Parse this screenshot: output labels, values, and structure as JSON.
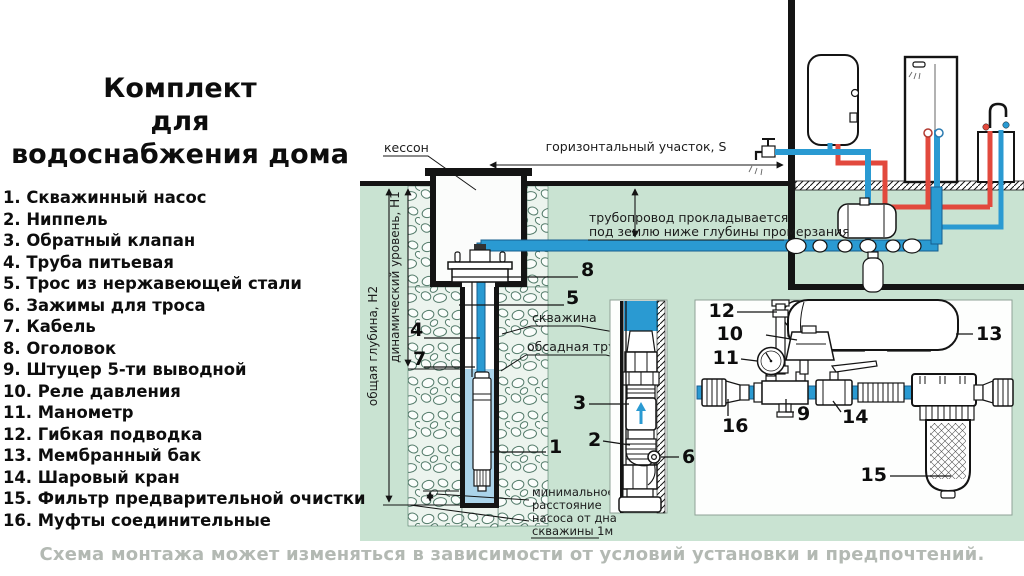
{
  "title": {
    "lines": [
      "Комплект",
      "для",
      "водоснабжения дома"
    ]
  },
  "parts_list": [
    "1. Скважинный насос",
    "2. Ниппель",
    "3. Обратный клапан",
    "4. Труба питьевая",
    "5. Трос из нержавеющей стали",
    "6. Зажимы для троса",
    "7. Кабель",
    "8. Оголовок",
    "9. Штуцер 5-ти выводной",
    "10. Реле давления",
    "11. Манометр",
    "12. Гибкая подводка",
    "13. Мембранный бак",
    "14. Шаровый кран",
    "15. Фильтр предварительной очистки",
    "16. Муфты соединительные"
  ],
  "caption": "Схема монтажа может изменяться в зависимости от условий установки и предпочтений.",
  "labels": {
    "kesson": "кессон",
    "horizontal_section": "горизонтальный участок, S",
    "pipeline_note1": "трубопровод прокладывается",
    "pipeline_note2": "под землю ниже глубины промерзания",
    "total_depth": "общая глубина, Н2",
    "dynamic_level": "динамический уровень, Н1",
    "borehole": "скважина",
    "casing_pipe": "обсадная труба",
    "min_distance1": "минимальное",
    "min_distance2": "расстояние",
    "min_distance3": "насоса от дна",
    "min_distance4": "скважины 1м"
  },
  "callouts": {
    "n1": "1",
    "n2": "2",
    "n3": "3",
    "n4": "4",
    "n5": "5",
    "n6": "6",
    "n7": "7",
    "n8": "8",
    "n9": "9",
    "n10": "10",
    "n11": "11",
    "n12": "12",
    "n13": "13",
    "n14": "14",
    "n15": "15",
    "n16": "16"
  },
  "colors": {
    "ground": "#c9e3d2",
    "pipe_blue": "#2a9ad2",
    "pipe_red": "#e2493d",
    "well_water": "#abd4ea",
    "caption_gray": "#b3b9b3"
  }
}
